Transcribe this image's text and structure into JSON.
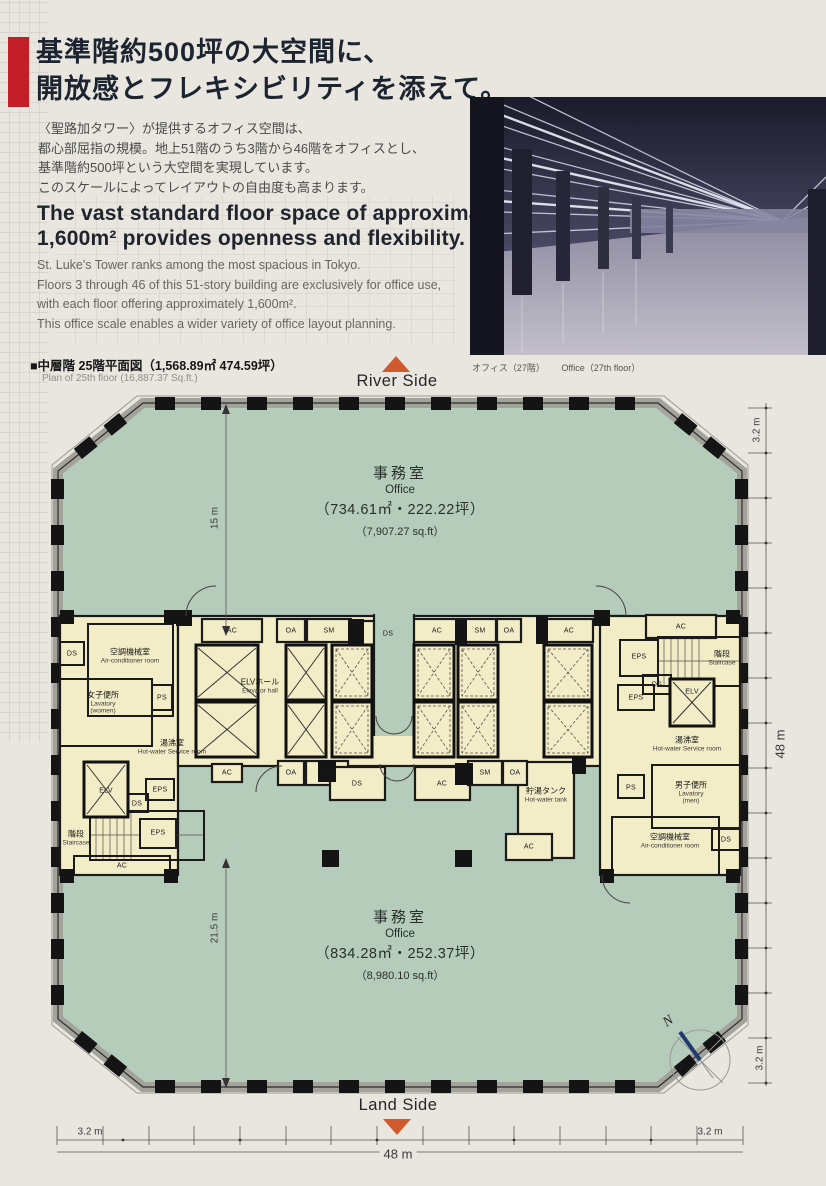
{
  "intro": {
    "headline_jp": [
      "基準階約500坪の大空間に、",
      "開放感とフレキシビリティを添えて。"
    ],
    "body_jp": [
      "〈聖路加タワー〉が提供するオフィス空間は、",
      "都心部屈指の規模。地上51階のうち3階から46階をオフィスとし、",
      "基準階約500坪という大空間を実現しています。",
      "このスケールによってレイアウトの自由度も高まります。"
    ],
    "headline_en": [
      "The vast standard floor space of approximately",
      "1,600m² provides openness and flexibility."
    ],
    "body_en": [
      "St. Luke's Tower ranks among the most spacious in Tokyo.",
      "Floors 3 through 46 of this 51-story building are exclusively for office use,",
      "with each floor offering approximately 1,600m².",
      "This office scale enables a wider variety of office layout planning."
    ]
  },
  "photo": {
    "caption_jp": "オフィス（27階）",
    "caption_en": "Office（27th floor）"
  },
  "plan": {
    "title_jp": "■中層階 25階平面図（1,568.89㎡ 474.59坪）",
    "title_en": "Plan of 25th floor (16,887.37 Sq.ft.)",
    "river_side": "River Side",
    "land_side": "Land Side",
    "north_label": "N",
    "office_upper": {
      "jp": "事務室",
      "en": "Office",
      "area": "（734.61㎡・222.22坪）",
      "sqft": "（7,907.27 sq.ft）"
    },
    "office_lower": {
      "jp": "事務室",
      "en": "Office",
      "area": "（834.28㎡・252.37坪）",
      "sqft": "（8,980.10 sq.ft）"
    },
    "rooms": [
      {
        "jp": "空調機械室",
        "en": "Air-conditioner room"
      },
      {
        "jp": "女子便所",
        "en": "Lavatory",
        "en2": "(women)"
      },
      {
        "jp": "ELVホール",
        "en": "Elevator hall"
      },
      {
        "jp": "湯沸室",
        "en": "Hot-water Service room"
      },
      {
        "jp": "階段",
        "en": "Staircase"
      },
      {
        "jp": "貯湯タンク",
        "en": "Hot-water tank"
      },
      {
        "jp": "階段",
        "en": "Staircase"
      },
      {
        "jp": "湯沸室",
        "en": "Hot-water Service room"
      },
      {
        "jp": "男子便所",
        "en": "Lavatory",
        "en2": "(men)"
      },
      {
        "jp": "空調機械室",
        "en": "Air-conditioner room"
      }
    ],
    "small_labels": [
      "AC",
      "OA",
      "SM",
      "DS",
      "AC",
      "SM",
      "OA",
      "AC",
      "AC",
      "DS",
      "PS",
      "EPS",
      "DS",
      "EPS",
      "ELV",
      "EPS",
      "DS",
      "ELV",
      "EPS",
      "AC",
      "AC",
      "OA",
      "SM",
      "DS",
      "AC",
      "SM",
      "OA",
      "AC",
      "PS",
      "DS"
    ],
    "dims": {
      "v_top": "3.2 m",
      "v_mid": "48 m",
      "v_bot": "3.2 m",
      "office_upper": "15 m",
      "office_lower": "21.5 m",
      "h_left": "3.2 m",
      "h_mid": "48 m",
      "h_right": "3.2 m"
    }
  },
  "colors": {
    "accent_red": "#c41e28",
    "triangle_orange": "#cf5a2d",
    "office_green": "#b6ccba",
    "core_cream": "#f2ecc7",
    "headline_navy": "#1c2430"
  }
}
